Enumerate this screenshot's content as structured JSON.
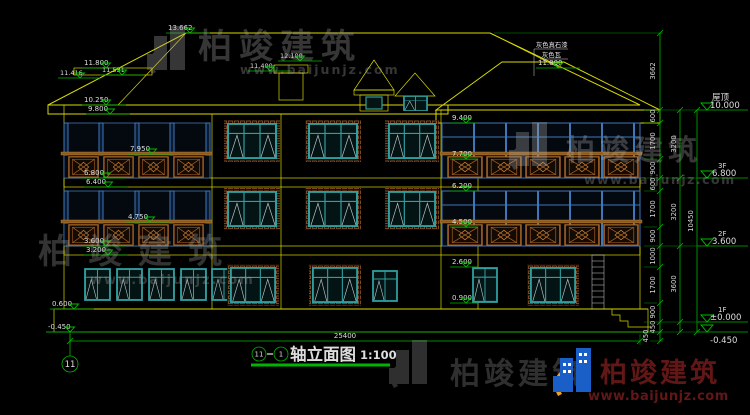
{
  "title": {
    "a": "11",
    "b": "1",
    "name": "轴立面图",
    "scale": "1:100"
  },
  "axis": {
    "bubble": "11"
  },
  "levels": {
    "roof_name": "屋顶",
    "roof": "10.000",
    "f3_name": "3F",
    "f3": "6.800",
    "f2_name": "2F",
    "f2": "3.600",
    "f1_name": "1F",
    "f1": "±0.000",
    "ground": "-0.450"
  },
  "marks": {
    "ridge": "13.662",
    "t1": "11.800",
    "t2": "11.416",
    "t3": "11.531",
    "t4": "11.400",
    "t5": "12.100",
    "t6": "11.800",
    "l1": "10.250",
    "l2": "9.800",
    "l3": "7.950",
    "l4": "6.800",
    "l5": "6.400",
    "l6": "4.750",
    "l7": "3.600",
    "l8": "3.200",
    "l9": "0.600",
    "l10": "-0.450",
    "c1": "9.400",
    "c2": "7.700",
    "c3": "6.200",
    "c4": "4.500",
    "c5": "2.600",
    "c6": "0.900"
  },
  "notes": {
    "n1": "灰色真石漆",
    "n2": "灰色瓦"
  },
  "dims": {
    "total_width": "25400",
    "roof_h": "3662",
    "total_h": "10450",
    "floors": [
      "3200",
      "3200",
      "3600"
    ],
    "detail": [
      "600",
      "1700",
      "900",
      "600",
      "1700",
      "900",
      "1000",
      "1700",
      "900",
      "450",
      "450"
    ]
  },
  "wm": {
    "brand": "柏竣建筑",
    "url": "www.baijunjz.com"
  }
}
